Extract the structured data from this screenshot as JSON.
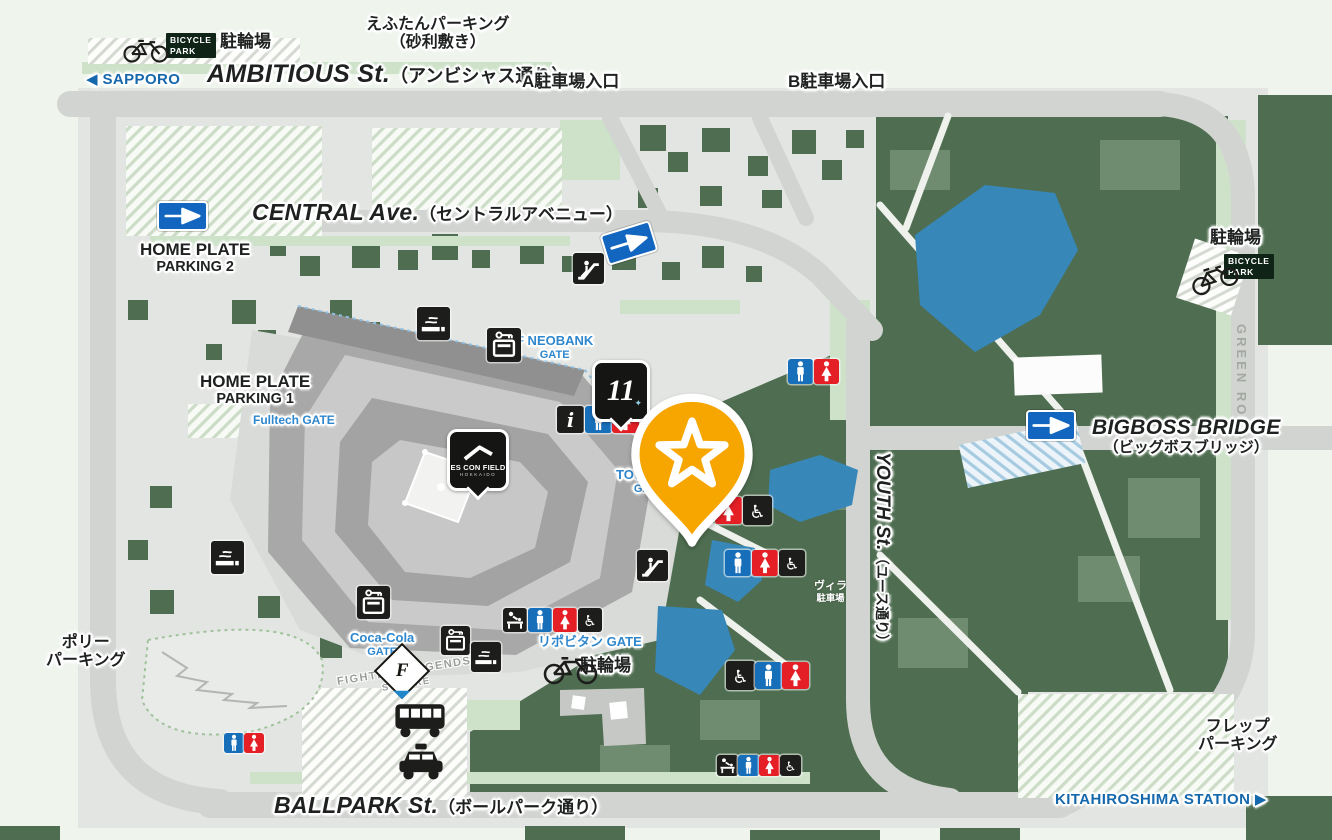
{
  "map": {
    "title": "ES CON FIELD HOKKAIDO area map",
    "colors": {
      "page_bg": "#eff5ed",
      "road": "#d2d4d1",
      "block": "#e3e5e2",
      "green_dark": "#4f6e51",
      "green_light": "#cde2c9",
      "pond_blue": "#3787b9",
      "stadium_gray": "#a7a8a7",
      "pin_orange": "#f7a600",
      "toilet_blue": "#176fba",
      "toilet_red": "#e51f26",
      "badge_black": "#1d1d1b",
      "gate_text": "#2f87cd",
      "direction_text": "#1668ad",
      "oneway_sign_blue": "#1266bf"
    },
    "labels": [
      {
        "name": "bicycle-parking-label-top-left",
        "cls": "plain halo",
        "x": 220,
        "y": 32,
        "lines": [
          "駐輪場"
        ]
      },
      {
        "name": "bicycle-park-sign-top-left",
        "cls": "bpark",
        "x": 166,
        "y": 33,
        "lines": [
          "BICYCLE",
          "PARK"
        ]
      },
      {
        "name": "eftan-parking-label",
        "cls": "plain halo center",
        "x": 366,
        "y": 16,
        "sz": 16,
        "lines": [
          "えふたんパーキング",
          "（砂利敷き）"
        ]
      },
      {
        "name": "direction-sapporo",
        "cls": "dir halo",
        "x": 86,
        "y": 72,
        "lines": [
          "◀ SAPPORO"
        ]
      },
      {
        "name": "ambitious-st-label",
        "cls": "street halo",
        "x": 207,
        "y": 60,
        "sz": 25,
        "en": "AMBITIOUS St.",
        "jp": "（アンビシャス通り）"
      },
      {
        "name": "parking-a-entrance-label",
        "cls": "plain halo",
        "x": 522,
        "y": 72,
        "lines": [
          "A駐車場入口"
        ]
      },
      {
        "name": "parking-b-entrance-label",
        "cls": "plain halo",
        "x": 788,
        "y": 72,
        "lines": [
          "B駐車場入口"
        ]
      },
      {
        "name": "central-ave-label",
        "cls": "street halo",
        "x": 252,
        "y": 200,
        "sz": 23,
        "en": "CENTRAL Ave.",
        "jp": "（セントラルアベニュー）"
      },
      {
        "name": "home-plate-parking-2-label",
        "cls": "plain halo center",
        "x": 140,
        "y": 240,
        "lines": [
          "HOME PLATE",
          "PARKING 2"
        ]
      },
      {
        "name": "home-plate-parking-1-label",
        "cls": "plain halo center",
        "x": 200,
        "y": 372,
        "lines": [
          "HOME PLATE",
          "PARKING 1"
        ]
      },
      {
        "name": "fulltech-gate-label",
        "cls": "gate halo",
        "x": 253,
        "y": 414,
        "sz": 12,
        "lines": [
          "Fulltech GATE"
        ]
      },
      {
        "name": "f-neobank-gate-label",
        "cls": "gate halo center",
        "x": 516,
        "y": 334,
        "lines": [
          "F NEOBANK",
          "GATE"
        ]
      },
      {
        "name": "bicycle-parking-label-right",
        "cls": "plain halo",
        "x": 1210,
        "y": 228,
        "lines": [
          "駐輪場"
        ]
      },
      {
        "name": "bicycle-park-sign-right",
        "cls": "bpark",
        "x": 1224,
        "y": 254,
        "lines": [
          "BICYCLE",
          "PARK"
        ]
      },
      {
        "name": "green-road-label",
        "cls": "groad",
        "x": 1248,
        "y": 324,
        "rot": 90,
        "lines": [
          "GREEN ROAD"
        ]
      },
      {
        "name": "bigboss-bridge-label",
        "cls": "street halo center",
        "x": 1092,
        "y": 416,
        "sz": 21,
        "stack": true,
        "en": "BIGBOSS BRIDGE",
        "jp": "（ビッグボスブリッジ）"
      },
      {
        "name": "tower-11-gate-label",
        "cls": "gate halo center",
        "x": 616,
        "y": 468,
        "lines": [
          "TOWER 11",
          "GATE"
        ]
      },
      {
        "name": "youth-st-label",
        "cls": "street halo",
        "x": 893,
        "y": 452,
        "sz": 19,
        "rot": 90,
        "en": "YOUTH St.",
        "jp": "（ユース通り）"
      },
      {
        "name": "villa-parking-label",
        "cls": "white center",
        "x": 814,
        "y": 580,
        "lines": [
          "ヴィラ",
          "駐車場"
        ]
      },
      {
        "name": "polly-parking-label",
        "cls": "plain halo center",
        "x": 46,
        "y": 634,
        "sz": 16,
        "lines": [
          "ポリー",
          "パーキング"
        ]
      },
      {
        "name": "coca-cola-gate-label",
        "cls": "gate halo center",
        "x": 350,
        "y": 631,
        "lines": [
          "Coca-Cola",
          "GATE"
        ]
      },
      {
        "name": "fighters-legends-square-label",
        "cls": "muted center",
        "x": 336,
        "y": 675,
        "rot": -9,
        "lines": [
          "FIGHTERS LEGENDS",
          "SQUARE"
        ]
      },
      {
        "name": "lipovitan-gate-label",
        "cls": "gate halo",
        "x": 538,
        "y": 635,
        "lines": [
          "リポビタン GATE"
        ]
      },
      {
        "name": "bicycle-parking-label-bottom",
        "cls": "plain halo",
        "x": 580,
        "y": 656,
        "lines": [
          "駐輪場"
        ]
      },
      {
        "name": "ballpark-st-label",
        "cls": "street halo",
        "x": 274,
        "y": 793,
        "sz": 23,
        "en": "BALLPARK St.",
        "jp": "（ボールパーク通り）"
      },
      {
        "name": "flep-parking-label",
        "cls": "plain halo center",
        "x": 1198,
        "y": 718,
        "sz": 16,
        "lines": [
          "フレップ",
          "パーキング"
        ]
      },
      {
        "name": "direction-kitahiroshima",
        "cls": "dir halo",
        "x": 1055,
        "y": 792,
        "lines": [
          "KITAHIROSHIMA STATION ▶"
        ]
      }
    ],
    "icons": [
      {
        "t": "bike",
        "x": 118,
        "y": 34,
        "w": 58,
        "h": 30
      },
      {
        "t": "oneway",
        "x": 157,
        "y": 201,
        "w": 47,
        "h": 26
      },
      {
        "t": "oneway",
        "x": 603,
        "y": 227,
        "w": 48,
        "h": 28,
        "r": -17
      },
      {
        "t": "escalator",
        "x": 573,
        "y": 253,
        "s": 31
      },
      {
        "t": "smoking",
        "x": 417,
        "y": 307,
        "s": 33
      },
      {
        "t": "locker",
        "x": 487,
        "y": 328,
        "s": 34
      },
      {
        "t": "info",
        "x": 557,
        "y": 406,
        "s": 27
      },
      {
        "t": "man",
        "x": 585,
        "y": 406,
        "s": 27
      },
      {
        "t": "woman",
        "x": 612,
        "y": 406,
        "s": 27
      },
      {
        "t": "man",
        "x": 788,
        "y": 359,
        "s": 25
      },
      {
        "t": "woman",
        "x": 814,
        "y": 359,
        "s": 25
      },
      {
        "t": "bike",
        "x": 1188,
        "y": 260,
        "w": 54,
        "h": 32,
        "r": -18
      },
      {
        "t": "oneway",
        "x": 1026,
        "y": 410,
        "w": 46,
        "h": 27
      },
      {
        "t": "woman",
        "x": 715,
        "y": 497,
        "s": 27
      },
      {
        "t": "wheelchair",
        "x": 743,
        "y": 496,
        "s": 29
      },
      {
        "t": "smoking",
        "x": 211,
        "y": 541,
        "s": 33
      },
      {
        "t": "escalator",
        "x": 637,
        "y": 550,
        "s": 31
      },
      {
        "t": "man",
        "x": 725,
        "y": 550,
        "s": 26
      },
      {
        "t": "woman",
        "x": 752,
        "y": 550,
        "s": 26
      },
      {
        "t": "wheelchair",
        "x": 779,
        "y": 550,
        "s": 26
      },
      {
        "t": "locker",
        "x": 357,
        "y": 586,
        "s": 33
      },
      {
        "t": "baby",
        "x": 503,
        "y": 608,
        "s": 24
      },
      {
        "t": "man",
        "x": 528,
        "y": 608,
        "s": 24
      },
      {
        "t": "woman",
        "x": 553,
        "y": 608,
        "s": 24
      },
      {
        "t": "wheelchair",
        "x": 578,
        "y": 608,
        "s": 24
      },
      {
        "t": "locker",
        "x": 441,
        "y": 626,
        "s": 29
      },
      {
        "t": "smoking",
        "x": 471,
        "y": 642,
        "s": 30
      },
      {
        "t": "flogo",
        "x": 382,
        "y": 651,
        "s": 36,
        "letter": "F"
      },
      {
        "t": "bike",
        "x": 541,
        "y": 650,
        "w": 62,
        "h": 36
      },
      {
        "t": "wheelchair",
        "x": 726,
        "y": 661,
        "s": 29
      },
      {
        "t": "man",
        "x": 755,
        "y": 662,
        "s": 27
      },
      {
        "t": "woman",
        "x": 782,
        "y": 662,
        "s": 27
      },
      {
        "t": "bus",
        "x": 392,
        "y": 702,
        "w": 56,
        "h": 38
      },
      {
        "t": "taxi",
        "x": 396,
        "y": 742,
        "w": 50,
        "h": 42
      },
      {
        "t": "man",
        "x": 224,
        "y": 733,
        "s": 20
      },
      {
        "t": "woman",
        "x": 244,
        "y": 733,
        "s": 20
      },
      {
        "t": "baby",
        "x": 717,
        "y": 755,
        "s": 21
      },
      {
        "t": "man",
        "x": 738,
        "y": 755,
        "s": 21
      },
      {
        "t": "woman",
        "x": 759,
        "y": 755,
        "s": 21
      },
      {
        "t": "wheelchair",
        "x": 780,
        "y": 755,
        "s": 21
      }
    ],
    "markers": {
      "star_pin": {
        "x": 623,
        "y": 392,
        "w": 138,
        "h": 155,
        "color": "#f7a600"
      },
      "escon_badge": {
        "x": 447,
        "y": 429,
        "w": 56,
        "h": 56,
        "line1": "ES CON FIELD",
        "line2": "HOKKAIDO"
      },
      "tower11_badge": {
        "x": 592,
        "y": 360,
        "w": 52,
        "h": 56,
        "number": "11",
        "sparkle": "✦"
      }
    }
  }
}
